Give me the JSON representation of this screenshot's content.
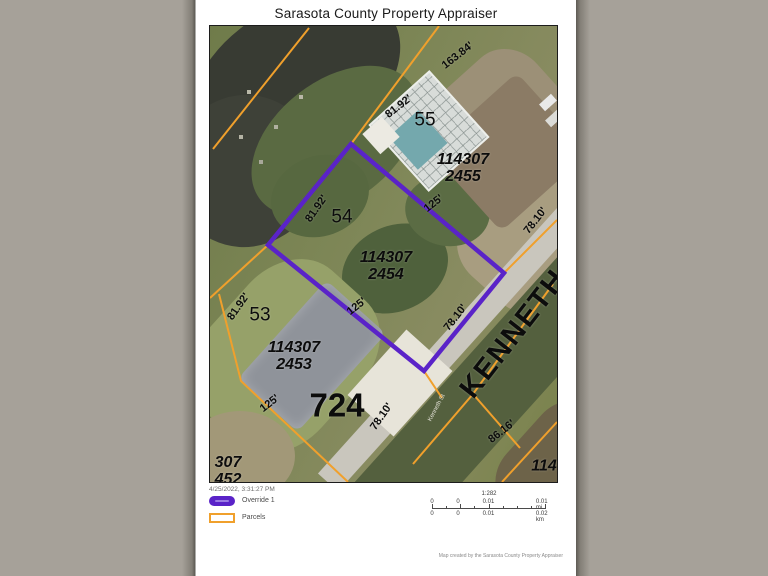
{
  "page": {
    "title": "Sarasota County Property Appraiser",
    "timestamp": "4/25/2022, 3:31:27 PM",
    "footer": "Map created by the Sarasota County Property Appraiser"
  },
  "legend": {
    "items": [
      {
        "label": "Override 1",
        "color": "#5a23c8"
      },
      {
        "label": "Parcels",
        "color": "#f0a02c"
      }
    ]
  },
  "scale": {
    "ratio": "1:282",
    "top": [
      "0",
      "0",
      "0.01",
      "0.01 mi"
    ],
    "bottom": [
      "0",
      "0",
      "0.01",
      "0.02 km"
    ]
  },
  "map": {
    "labels": [
      "163.84'",
      "81.92'",
      "55",
      "114307\n2455",
      "125'",
      "78.10'",
      "81.92'",
      "54",
      "114307\n2454",
      "125'",
      "78.10'",
      "81.92'",
      "53",
      "114307\n2453",
      "125'",
      "724",
      "78.10'",
      "86.16'",
      "114",
      "307\n452",
      "KENNETH",
      "Kenneth St"
    ],
    "override_color": "#5a23c8",
    "parcel_line_color": "#f0a02c"
  }
}
